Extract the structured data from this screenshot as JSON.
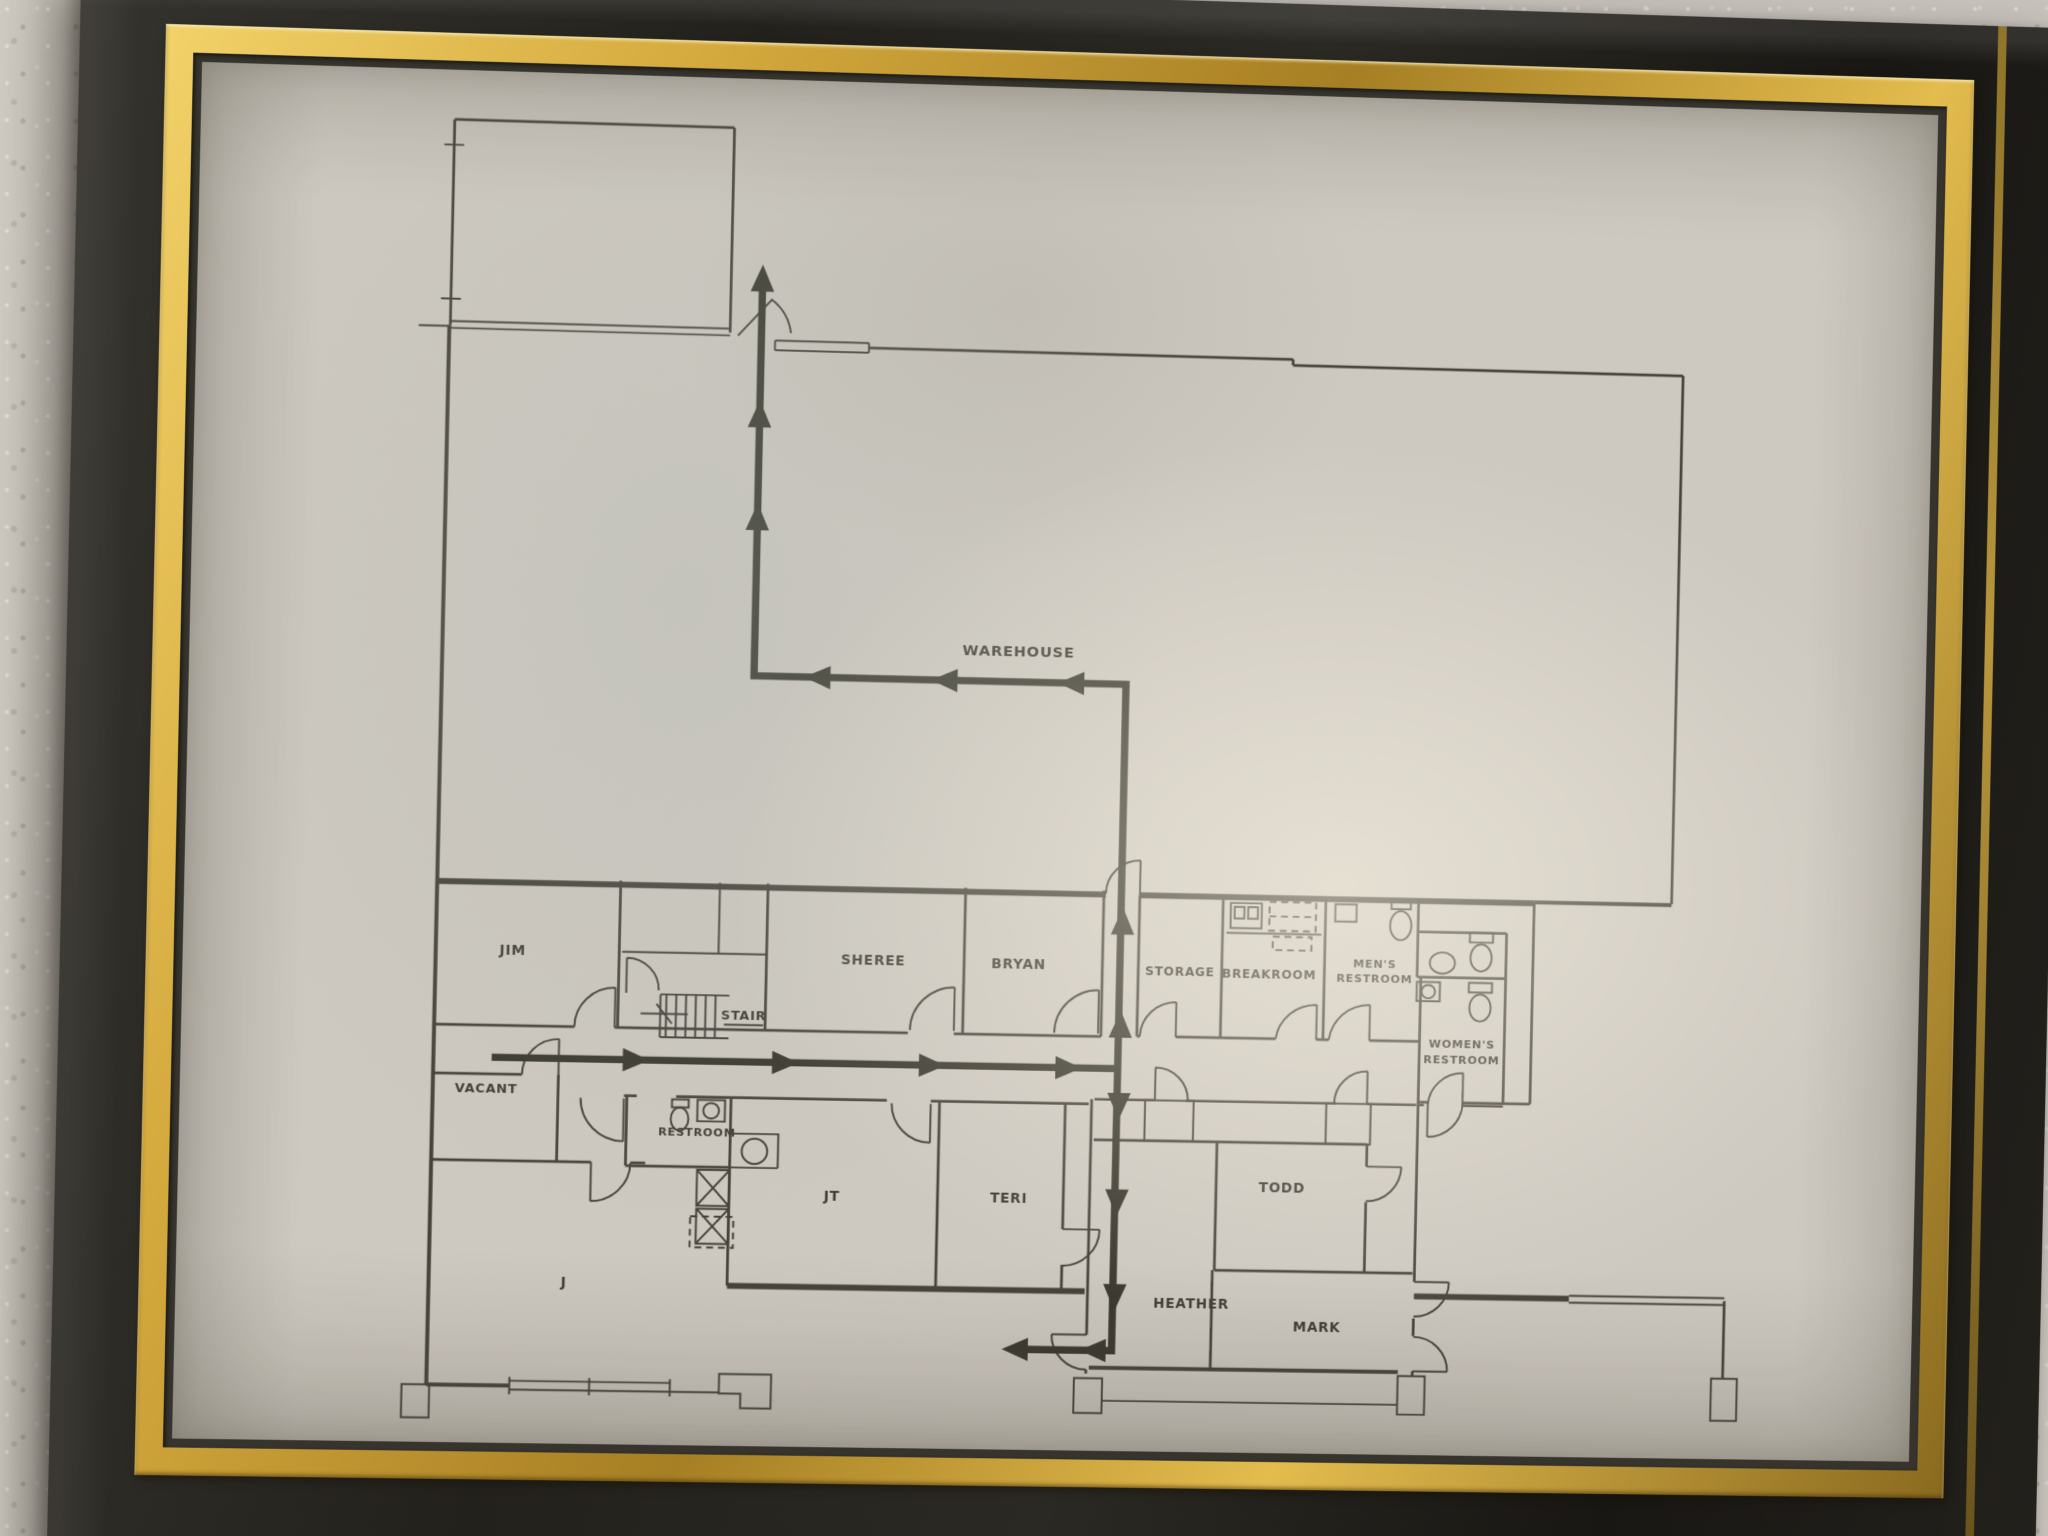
{
  "scene": {
    "subject": "framed office evacuation floor plan photographed on a stucco wall",
    "colors": {
      "wall": "#c8c3bc",
      "frame_black": "#23211c",
      "frame_gold": "#c9a440",
      "paper": "#cdc8c0",
      "ink": "#45423b",
      "route": "#3a382f"
    }
  },
  "plan": {
    "rooms": {
      "warehouse": "WAREHOUSE",
      "jim": "JIM",
      "stair": "STAIR",
      "sheree": "SHEREE",
      "bryan": "BRYAN",
      "storage": "STORAGE",
      "breakroom": "BREAKROOM",
      "mens_line1": "MEN'S",
      "mens_line2": "RESTROOM",
      "womens_line1": "WOMEN'S",
      "womens_line2": "RESTROOM",
      "vacant": "VACANT",
      "restroom": "RESTROOM",
      "jt": "JT",
      "teri": "TERI",
      "todd": "TODD",
      "heather": "HEATHER",
      "mark": "MARK",
      "j": "J"
    }
  }
}
